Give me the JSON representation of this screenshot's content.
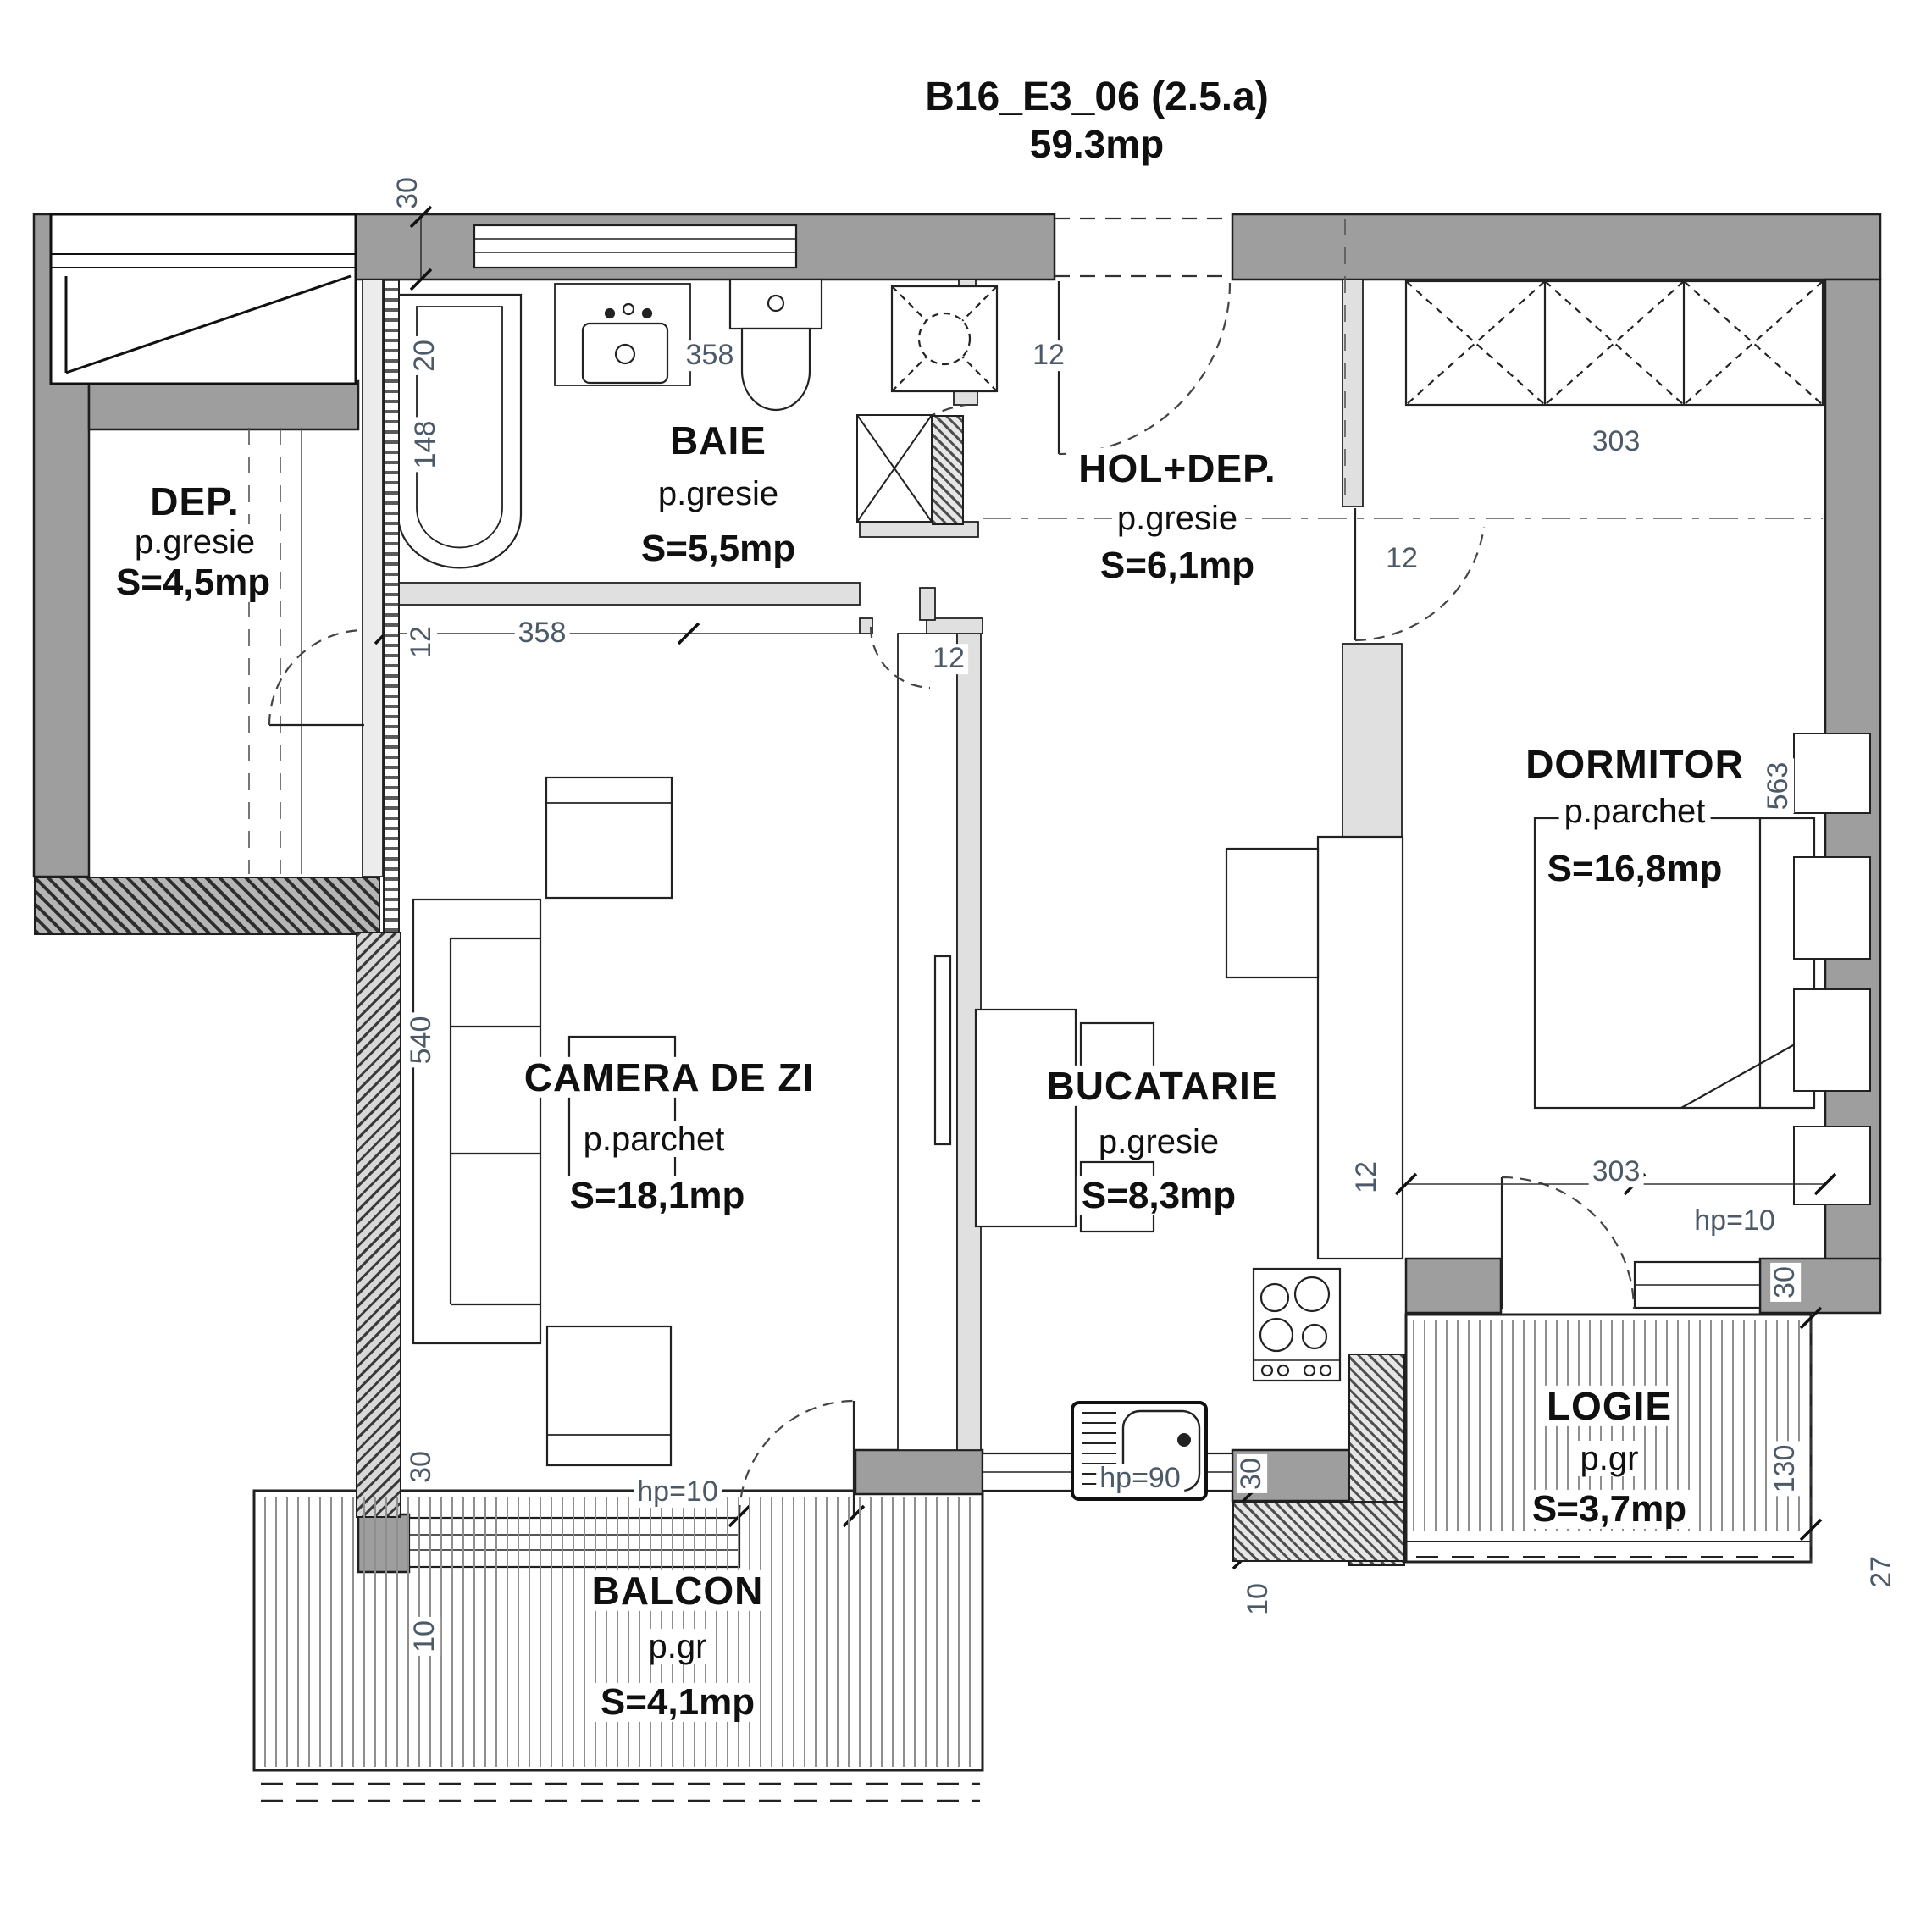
{
  "title": {
    "line1": "B16_E3_06 (2.5.a)",
    "line2": "59.3mp"
  },
  "rooms": [
    {
      "id": "baie",
      "name": "BAIE",
      "floor": "p.gresie",
      "area": "S=5,5mp"
    },
    {
      "id": "hol",
      "name": "HOL+DEP.",
      "floor": "p.gresie",
      "area": "S=6,1mp"
    },
    {
      "id": "dep",
      "name": "DEP.",
      "floor": "p.gresie",
      "area": "S=4,5mp"
    },
    {
      "id": "dormitor",
      "name": "DORMITOR",
      "floor": "p.parchet",
      "area": "S=16,8mp"
    },
    {
      "id": "camera",
      "name": "CAMERA DE ZI",
      "floor": "p.parchet",
      "area": "S=18,1mp"
    },
    {
      "id": "bucatarie",
      "name": "BUCATARIE",
      "floor": "p.gresie",
      "area": "S=8,3mp"
    },
    {
      "id": "logie",
      "name": "LOGIE",
      "floor": "p.gr",
      "area": "S=3,7mp"
    },
    {
      "id": "balcon",
      "name": "BALCON",
      "floor": "p.gr",
      "area": "S=4,1mp"
    }
  ],
  "dims": [
    {
      "id": "wall-top-left",
      "value": "30"
    },
    {
      "id": "bath-20",
      "value": "20"
    },
    {
      "id": "tub-148",
      "value": "148"
    },
    {
      "id": "bath-wall-12",
      "value": "12"
    },
    {
      "id": "bath-358",
      "value": "358"
    },
    {
      "id": "living-358",
      "value": "358"
    },
    {
      "id": "entrance-12",
      "value": "12"
    },
    {
      "id": "dorm-door-12",
      "value": "12"
    },
    {
      "id": "wardrobe-303",
      "value": "303"
    },
    {
      "id": "dorm-563",
      "value": "563"
    },
    {
      "id": "dorm-303",
      "value": "303"
    },
    {
      "id": "dorm-hp10",
      "value": "hp=10"
    },
    {
      "id": "logie-30",
      "value": "30"
    },
    {
      "id": "logie-130",
      "value": "130"
    },
    {
      "id": "logie-27",
      "value": "27"
    },
    {
      "id": "kitchen-wall-12",
      "value": "12"
    },
    {
      "id": "kitchen-door-12",
      "value": "12"
    },
    {
      "id": "sink-hp90",
      "value": "hp=90"
    },
    {
      "id": "kitchen-30",
      "value": "30"
    },
    {
      "id": "kitchen-10",
      "value": "10"
    },
    {
      "id": "living-540",
      "value": "540"
    },
    {
      "id": "living-hp10",
      "value": "hp=10"
    },
    {
      "id": "living-30",
      "value": "30"
    },
    {
      "id": "balcon-10",
      "value": "10"
    }
  ]
}
